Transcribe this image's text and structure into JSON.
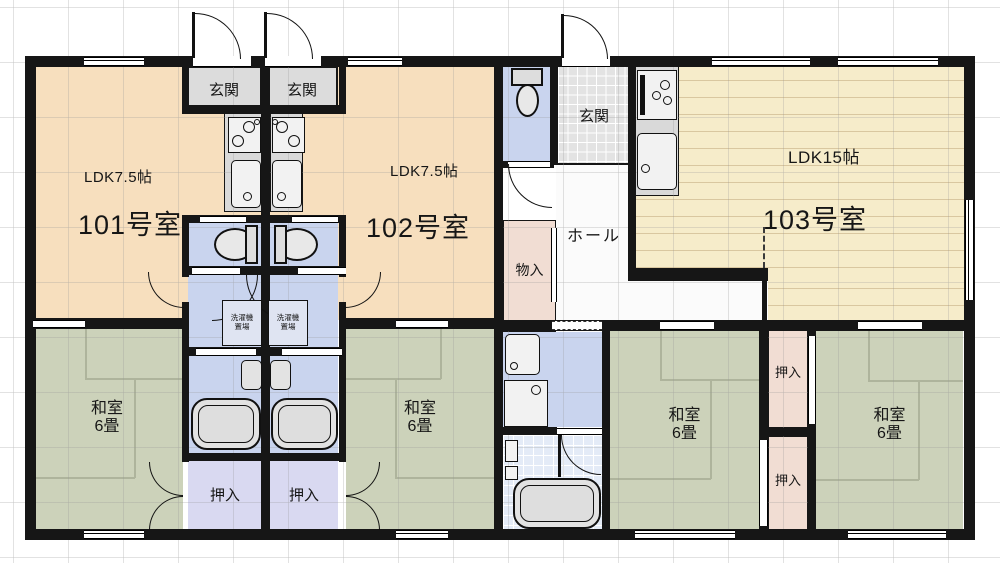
{
  "units": [
    {
      "id": "101",
      "room_label": "101号室",
      "ldk_label": "LDK7.5帖"
    },
    {
      "id": "102",
      "room_label": "102号室",
      "ldk_label": "LDK7.5帖"
    },
    {
      "id": "103",
      "room_label": "103号室",
      "ldk_label": "LDK15帖"
    }
  ],
  "labels": {
    "genkan": "玄関",
    "hall": "ホール",
    "monoire": "物入",
    "oshiire": "押入",
    "washitsu": "和室",
    "tatami_size": "6畳",
    "laundry_line1": "洗濯機",
    "laundry_line2": "置場"
  },
  "colors": {
    "wall": "#161616",
    "ldk_floor": "#f7dfbe",
    "ldk15_floor": "#f6ecca",
    "tatami_floor": "#ccd2ba",
    "wet_area_floor": "#c9d4ee",
    "closet_101_102": "#d9d9f1",
    "closet_103": "#f1ddd3",
    "entry_floor": "#dcdcdc",
    "hall_floor": "#fbfbfb"
  }
}
